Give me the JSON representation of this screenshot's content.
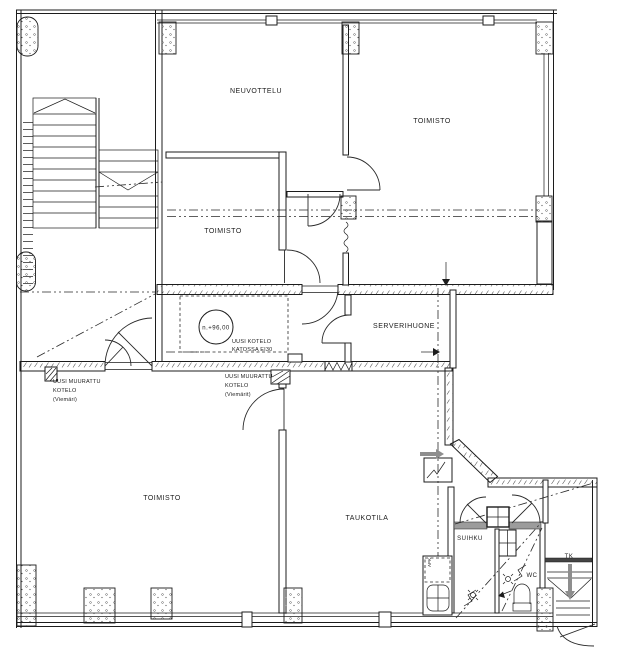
{
  "drawing": {
    "type": "architectural-floor-plan",
    "rooms": {
      "neuvottelu": "NEUVOTTELU",
      "toimisto_top": "TOIMISTO",
      "toimisto_small": "TOIMISTO",
      "serverihuone": "SERVERIHUONE",
      "toimisto_bottom": "TOIMISTO",
      "taukotila": "TAUKOTILA",
      "suihku": "SUIHKU",
      "wc": "WC",
      "tk": "TK"
    },
    "annotations": {
      "level_mark": "n.+96,00",
      "ceiling_duct_line1": "UUSI KOTELO",
      "ceiling_duct_line2": "KATOSSA EI30",
      "mid_duct_line1": "UUSI MUURATTU",
      "mid_duct_line2": "KOTELO",
      "mid_duct_line3": "(Viemärit)",
      "left_duct_line1": "UUSI MUURATTU",
      "left_duct_line2": "KOTELO",
      "left_duct_line3": "(Viemäri)",
      "appliance": "APK"
    },
    "colors": {
      "line": "#1c1c1c",
      "new_wall_gray": "#9c9c9c",
      "arrow_gray": "#8e8e8e",
      "background": "#ffffff"
    }
  }
}
